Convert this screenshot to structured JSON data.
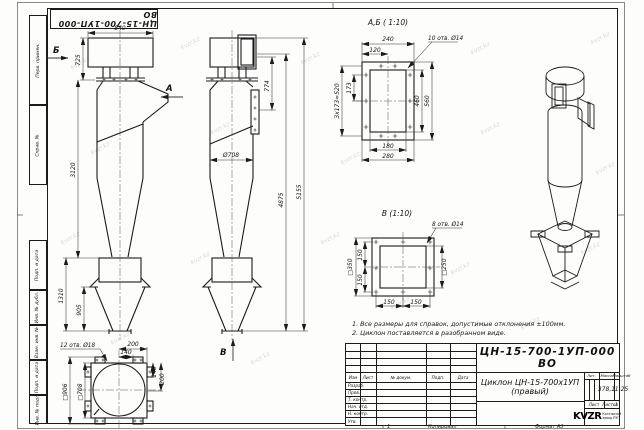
{
  "watermark": {
    "text": "kvzr.kz"
  },
  "stamp_top": {
    "doc_number": "ЦН-15-700-1УП-000 ВО"
  },
  "side_labels": [
    "Перв. примен.",
    "Справ. №",
    "Подп. и дата",
    "Инв. № дубл.",
    "Взам. инв. №",
    "Подп. и дата",
    "Инв. № подл."
  ],
  "notes": [
    "1. Все размеры для справок, допустимые отклонения ±100мм.",
    "2. Циклон поставляется в разобранном виде."
  ],
  "front_view": {
    "label_b": "Б",
    "label_a": "А",
    "dim_840": "840",
    "dim_725": "725",
    "dim_3120": "3120",
    "dim_1310": "1310",
    "dim_905": "905"
  },
  "side_view": {
    "label_v": "В",
    "dim_774": "774",
    "dim_d708": "Ø708",
    "dim_4875": "4875",
    "dim_5155": "5155"
  },
  "bottom_view": {
    "holes_note": "12 отв. Ø18",
    "dim_200_top": "200",
    "dim_140_top": "140",
    "dim_140_right": "140",
    "dim_200_right": "200",
    "dim_sq906": "□906",
    "dim_sq708": "□708"
  },
  "detail_ab": {
    "title": "А,Б ( 1:10)",
    "holes_note": "10 отв. Ø14",
    "dim_240": "240",
    "dim_120": "120",
    "dim_173": "173",
    "dim_520": "3х173=520",
    "dim_460": "460",
    "dim_560": "560",
    "dim_180": "180",
    "dim_280": "280"
  },
  "detail_v": {
    "title": "В (1:10)",
    "holes_note": "8 отв. Ø14",
    "dim_sq350": "□350",
    "dim_150_l1": "150",
    "dim_150_l2": "150",
    "dim_sq250": "□250",
    "dim_150_b1": "150",
    "dim_150_b2": "150"
  },
  "title_block": {
    "doc_number": "ЦН-15-700-1УП-000 ВО",
    "name_line1": "Циклон ЦН-15-700х1УП",
    "name_line2": "(правый)",
    "col_izm": "Изм",
    "col_list": "Лист",
    "col_doc": "№ докум.",
    "col_podp": "Подп.",
    "col_data": "Дата",
    "rows": [
      "Разраб.",
      "Пров.",
      "Т. контр.",
      "Нач. отд.",
      "Н. контр.",
      "Утв."
    ],
    "lit": "Лит.",
    "mass_label": "Масса",
    "scale_label": "Масштаб",
    "mass_value": "378,1",
    "scale_value": "1:25",
    "sheet_label": "Лист",
    "sheets_label": "Листов",
    "sheets_value": "1",
    "logo_text": "KVZR",
    "logo_caption1": "Котельный",
    "logo_caption2": "завод РЭП"
  },
  "footer": {
    "num": "1",
    "copied": "Копировал",
    "format": "Формат А3"
  }
}
